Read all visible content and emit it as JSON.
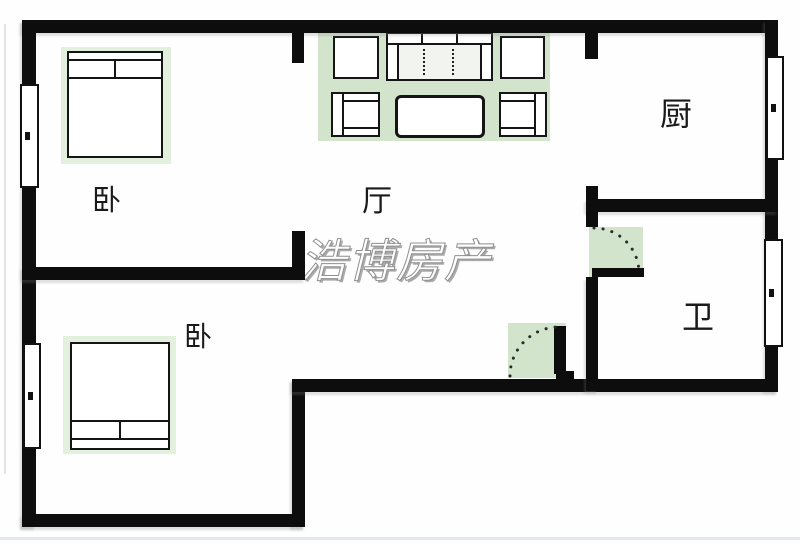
{
  "watermark": {
    "text": "浩博房产"
  },
  "rooms": [
    {
      "name": "bedroom-top",
      "label": "卧"
    },
    {
      "name": "living-room",
      "label": "厅"
    },
    {
      "name": "kitchen",
      "label": "厨"
    },
    {
      "name": "bedroom-bottom",
      "label": "卧"
    },
    {
      "name": "bathroom",
      "label": "卫"
    }
  ],
  "colors": {
    "wall": "#0d0d0d",
    "door_swing_green": "#d2e4cc",
    "bed_highlight_green": "#e4f0de",
    "watermark_fill": "#ffffff",
    "watermark_outline": "#909090",
    "background": "#fefefe"
  }
}
